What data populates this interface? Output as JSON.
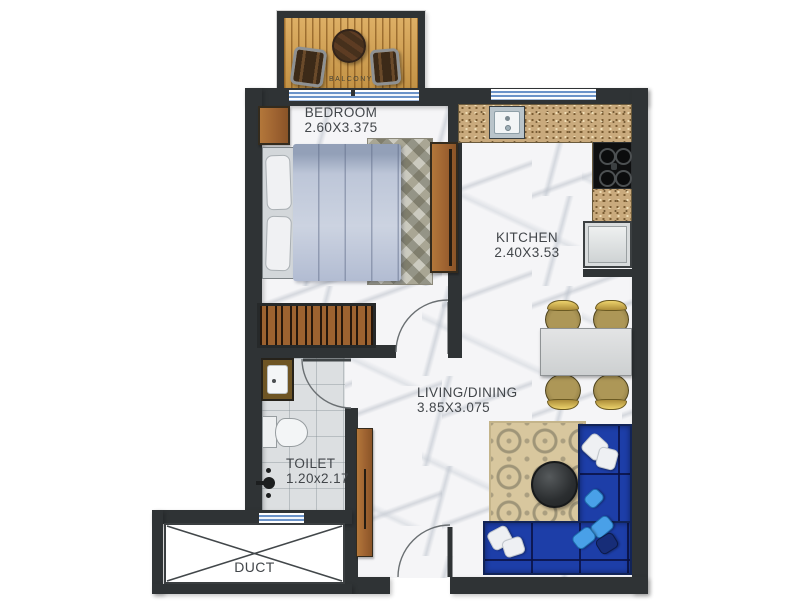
{
  "title": "Apartment floor plan",
  "rooms": {
    "bedroom": {
      "label": "BEDROOM",
      "dimensions": "2.60X3.375"
    },
    "kitchen": {
      "label": "KITCHEN",
      "dimensions": "2.40X3.53"
    },
    "living_dining": {
      "label": "LIVING/DINING",
      "dimensions": "3.85X3.075"
    },
    "toilet": {
      "label": "TOILET",
      "dimensions": "1.20x2.17"
    },
    "balcony": {
      "label": "BALCONY"
    },
    "duct": {
      "label": "DUCT"
    }
  },
  "colors": {
    "wall": "#2f3335",
    "marble_floor": "#f5f5f7",
    "tile_floor": "#dcdfe1",
    "counter_granite": "#c9aa7d",
    "balcony_wood": "#d8a24c",
    "furniture_wood": "#9c6130",
    "sofa_blue": "#1d3ea8",
    "pillow_light_blue": "#49a0e8",
    "window_blue": "#6b93c9",
    "label_text": "#42464a"
  }
}
